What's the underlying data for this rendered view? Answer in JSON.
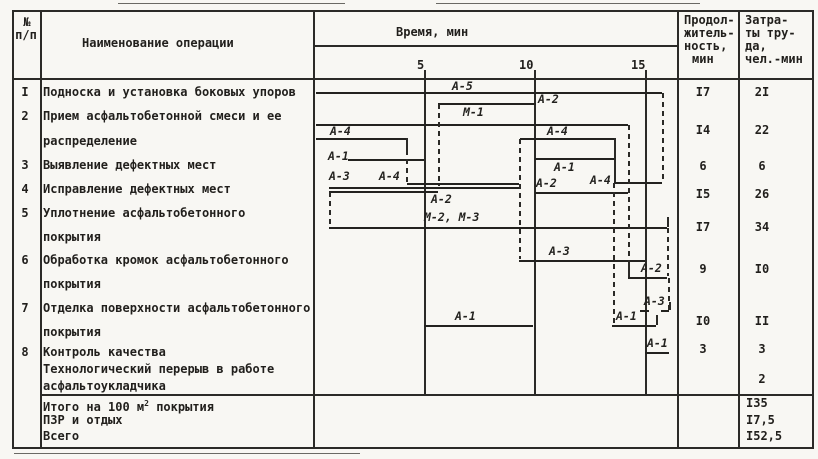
{
  "header": {
    "col_num_line1": "№",
    "col_num_line2": "п/п",
    "col_name": "Наименование операции",
    "col_time": "Время, мин",
    "duration_lines": [
      "Продол-",
      "житель-",
      "ность,",
      "мин"
    ],
    "labor_lines": [
      "Затра-",
      "ты тру-",
      "да,",
      "чел.-мин"
    ],
    "ticks": [
      "5",
      "10",
      "15"
    ]
  },
  "rows": [
    {
      "num": "I",
      "lines": [
        "Подноска и установка боковых упоров"
      ],
      "duration": "I7",
      "labor": "2I"
    },
    {
      "num": "2",
      "lines": [
        "Прием асфальтобетонной смеси и ее",
        "распределение"
      ],
      "duration": "I4",
      "labor": "22"
    },
    {
      "num": "3",
      "lines": [
        "Выявление дефектных мест"
      ],
      "duration": "6",
      "labor": "6"
    },
    {
      "num": "4",
      "lines": [
        "Исправление дефектных мест"
      ],
      "duration": "I5",
      "labor": "26"
    },
    {
      "num": "5",
      "lines": [
        "Уплотнение асфальтобетонного",
        "покрытия"
      ],
      "duration": "I7",
      "labor": "34"
    },
    {
      "num": "6",
      "lines": [
        "Обработка кромок асфальтобетонного",
        "покрытия"
      ],
      "duration": "9",
      "labor": "I0"
    },
    {
      "num": "7",
      "lines": [
        "Отделка поверхности асфальтобетонного",
        "покрытия"
      ],
      "duration": "I0",
      "labor": "II"
    },
    {
      "num": "8",
      "lines": [
        "Контроль качества"
      ],
      "duration": "3",
      "labor": "3"
    },
    {
      "num": "",
      "lines": [
        "Технологический перерыв в работе",
        "асфальтоукладчика"
      ],
      "duration": "",
      "labor": "2"
    }
  ],
  "totals": [
    {
      "pre": "Итого на 100 м",
      "sup": "2",
      "post": " покрытия",
      "value": "I35"
    },
    {
      "pre": "ПЗР и отдых",
      "sup": "",
      "post": "",
      "value": "I7,5"
    },
    {
      "pre": "Всего",
      "sup": "",
      "post": "",
      "value": "I52,5"
    }
  ],
  "gantt": {
    "axis_minutes": [
      5,
      10,
      15
    ],
    "px_per_minute": 22,
    "origin_x": 314,
    "bars": [
      {
        "label": "",
        "y": 92,
        "x1": 316,
        "x2": 662
      },
      {
        "label": "",
        "y": 103,
        "x1": 438,
        "x2": 536
      },
      {
        "label": "",
        "y": 124,
        "x1": 316,
        "x2": 628
      },
      {
        "label": "",
        "y": 138,
        "x1": 316,
        "x2": 406
      },
      {
        "label": "",
        "y": 159,
        "x1": 348,
        "x2": 424
      },
      {
        "label": "",
        "y": 138,
        "x1": 520,
        "x2": 614
      },
      {
        "label": "",
        "y": 158,
        "x1": 535,
        "x2": 614
      },
      {
        "label": "",
        "y": 182,
        "x1": 614,
        "x2": 662
      },
      {
        "label": "",
        "y": 183,
        "x1": 407,
        "x2": 519
      },
      {
        "label": "",
        "y": 187,
        "x1": 329,
        "x2": 519
      },
      {
        "label": "",
        "y": 191,
        "x1": 329,
        "x2": 438
      },
      {
        "label": "",
        "y": 192,
        "x1": 535,
        "x2": 628
      },
      {
        "label": "",
        "y": 227,
        "x1": 329,
        "x2": 667
      },
      {
        "label": "",
        "y": 260,
        "x1": 519,
        "x2": 645
      },
      {
        "label": "",
        "y": 277,
        "x1": 628,
        "x2": 667
      },
      {
        "label": "",
        "y": 325,
        "x1": 424,
        "x2": 533
      },
      {
        "label": "",
        "y": 325,
        "x1": 612,
        "x2": 656
      },
      {
        "label": "",
        "y": 352,
        "x1": 645,
        "x2": 669
      },
      {
        "label": "",
        "y": 310,
        "x1": 640,
        "x2": 649
      },
      {
        "label": "",
        "y": 310,
        "x1": 661,
        "x2": 669
      }
    ],
    "hooks": [
      {
        "x": 667,
        "y1": 217,
        "y2": 227
      },
      {
        "x": 656,
        "y1": 315,
        "y2": 325
      },
      {
        "x": 614,
        "y1": 138,
        "y2": 182
      },
      {
        "x": 628,
        "y1": 260,
        "y2": 277
      },
      {
        "x": 406,
        "y1": 138,
        "y2": 150
      },
      {
        "x": 669,
        "y1": 302,
        "y2": 310
      }
    ],
    "dashes": [
      {
        "x": 662,
        "y1": 93,
        "y2": 182
      },
      {
        "x": 438,
        "y1": 104,
        "y2": 186
      },
      {
        "x": 628,
        "y1": 125,
        "y2": 259
      },
      {
        "x": 406,
        "y1": 150,
        "y2": 182
      },
      {
        "x": 519,
        "y1": 139,
        "y2": 259
      },
      {
        "x": 613,
        "y1": 183,
        "y2": 324
      },
      {
        "x": 329,
        "y1": 192,
        "y2": 226
      },
      {
        "x": 667,
        "y1": 228,
        "y2": 276
      },
      {
        "x": 668,
        "y1": 278,
        "y2": 311
      }
    ],
    "labels": [
      {
        "t": "А-5",
        "x": 452,
        "y": 80
      },
      {
        "t": "А-2",
        "x": 538,
        "y": 93
      },
      {
        "t": "М-1",
        "x": 463,
        "y": 106
      },
      {
        "t": "А-4",
        "x": 330,
        "y": 125
      },
      {
        "t": "А-1",
        "x": 328,
        "y": 150
      },
      {
        "t": "А-4",
        "x": 547,
        "y": 125
      },
      {
        "t": "А-1",
        "x": 554,
        "y": 161
      },
      {
        "t": "А-3",
        "x": 329,
        "y": 170
      },
      {
        "t": "А-4",
        "x": 379,
        "y": 170
      },
      {
        "t": "А-2",
        "x": 431,
        "y": 193
      },
      {
        "t": "А-2",
        "x": 536,
        "y": 177
      },
      {
        "t": "А-4",
        "x": 590,
        "y": 174
      },
      {
        "t": "М-2, М-3",
        "x": 424,
        "y": 211
      },
      {
        "t": "А-3",
        "x": 549,
        "y": 245
      },
      {
        "t": "А-2",
        "x": 641,
        "y": 262
      },
      {
        "t": "А-3",
        "x": 644,
        "y": 295
      },
      {
        "t": "А-1",
        "x": 455,
        "y": 310
      },
      {
        "t": "А-1",
        "x": 616,
        "y": 310
      },
      {
        "t": "А-1",
        "x": 647,
        "y": 337
      }
    ]
  }
}
